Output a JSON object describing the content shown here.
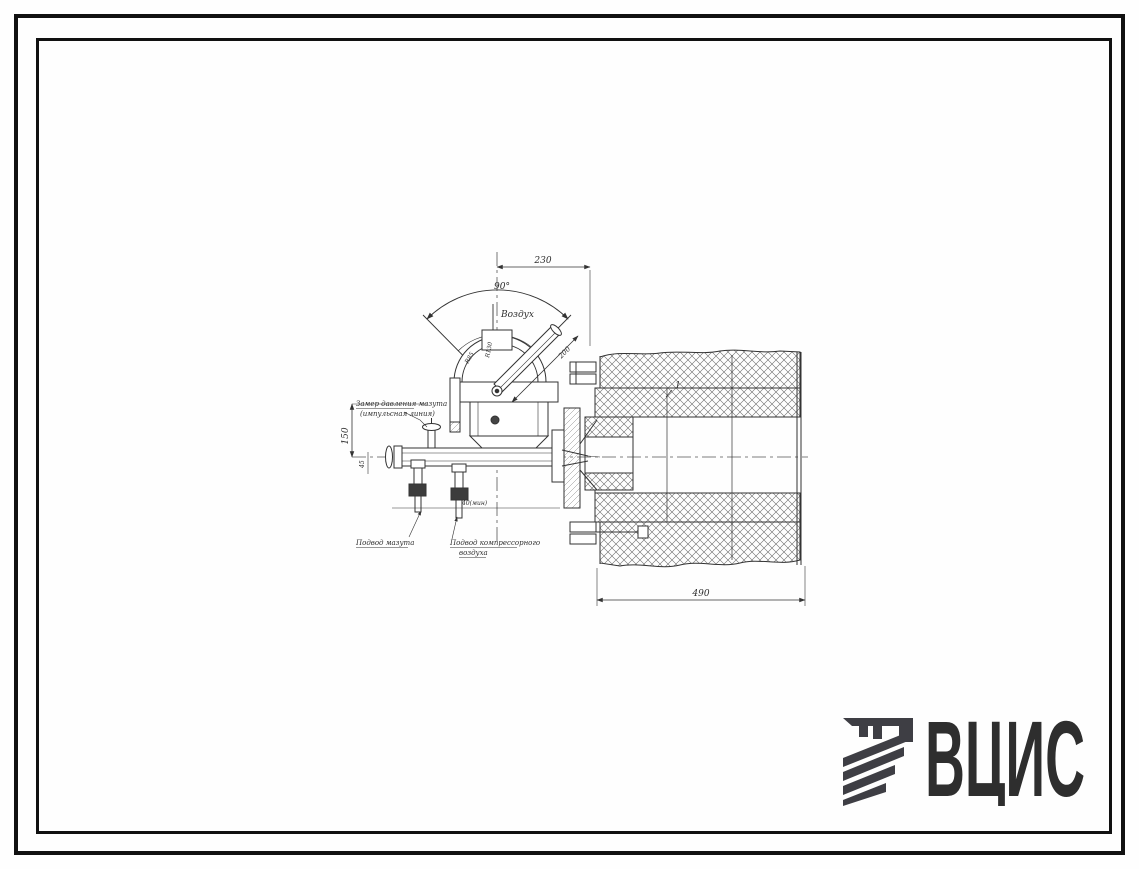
{
  "logo": {
    "text": "ВЦИС",
    "color": "#3e3e44"
  },
  "drawing": {
    "labels": {
      "air_flow": "Воздух",
      "angle_90": "90°",
      "dim_230": "230",
      "dim_200": "200",
      "dim_150": "150",
      "dim_45": "45",
      "dim_490": "490",
      "dim_40_min": "40(мин)",
      "radius_inner": "R85",
      "radius_outer": "R130",
      "callout_1": "1",
      "pressure_tap_line1": "Замер давления мазута",
      "pressure_tap_line2": "(импульсная линия)",
      "fuel_supply": "Подвод мазута",
      "compressed_air_line1": "Подвод компрессорного",
      "compressed_air_line2": "воздуха"
    }
  }
}
